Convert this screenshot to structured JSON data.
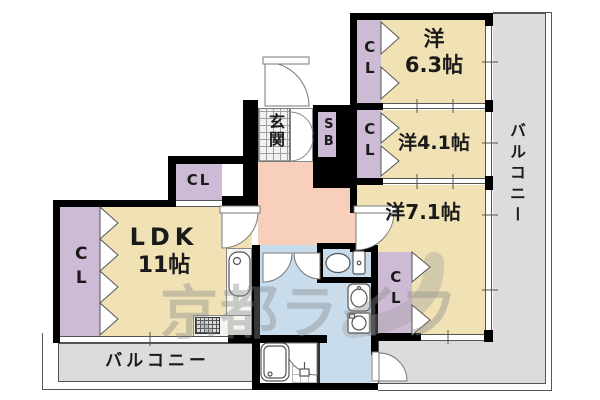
{
  "watermark": "京都ライフ",
  "labels": {
    "room63_line1": "洋",
    "room63_line2": "6.3帖",
    "room41": "洋4.1帖",
    "room71": "洋7.1帖",
    "ldk_line1": "LDK",
    "ldk_line2": "11帖",
    "closet": "CL",
    "shoe_box": "SB",
    "entrance": "玄関",
    "balcony": "バルコニー"
  },
  "colors": {
    "room": "#f0e2b4",
    "closet": "#cdbbd5",
    "hall": "#f8cfba",
    "wet": "#c9dcec",
    "balcony": "#dcdcdc",
    "wall": "#000000",
    "line": "#555555",
    "watermark": "#8a8a8a"
  },
  "fixtures": [
    "entrance-door-icon",
    "kitchen-sink-icon",
    "gas-stove-icon",
    "toilet-icon",
    "washbasin-icon",
    "washing-machine-icon",
    "bathtub-icon",
    "shower-drain-icon",
    "folding-door-icon",
    "sliding-window-icon",
    "door-swing-icon"
  ]
}
